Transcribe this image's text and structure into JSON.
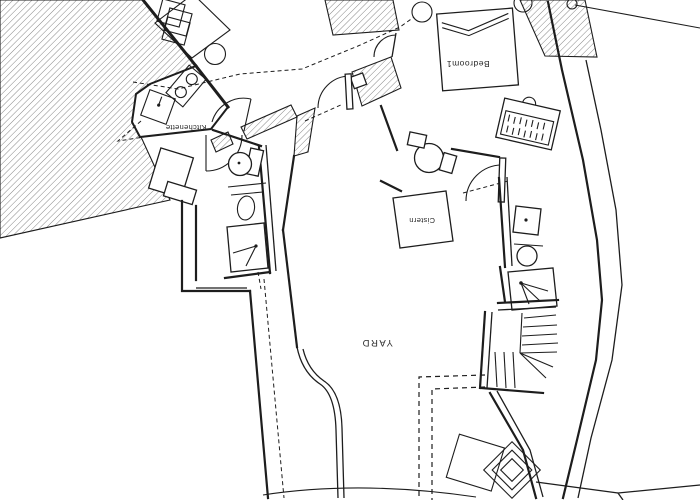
{
  "drawing": {
    "kind": "architectural floor plan (rotated 180°)",
    "labels": {
      "bedroom": "Bedroom1",
      "kitchenette": "Kitchenette",
      "cistern": "Cistern",
      "yard": "YARD"
    },
    "colors": {
      "background": "#ffffff",
      "ink": "#1d1d1d",
      "hatch": "#7a7a7a"
    }
  }
}
